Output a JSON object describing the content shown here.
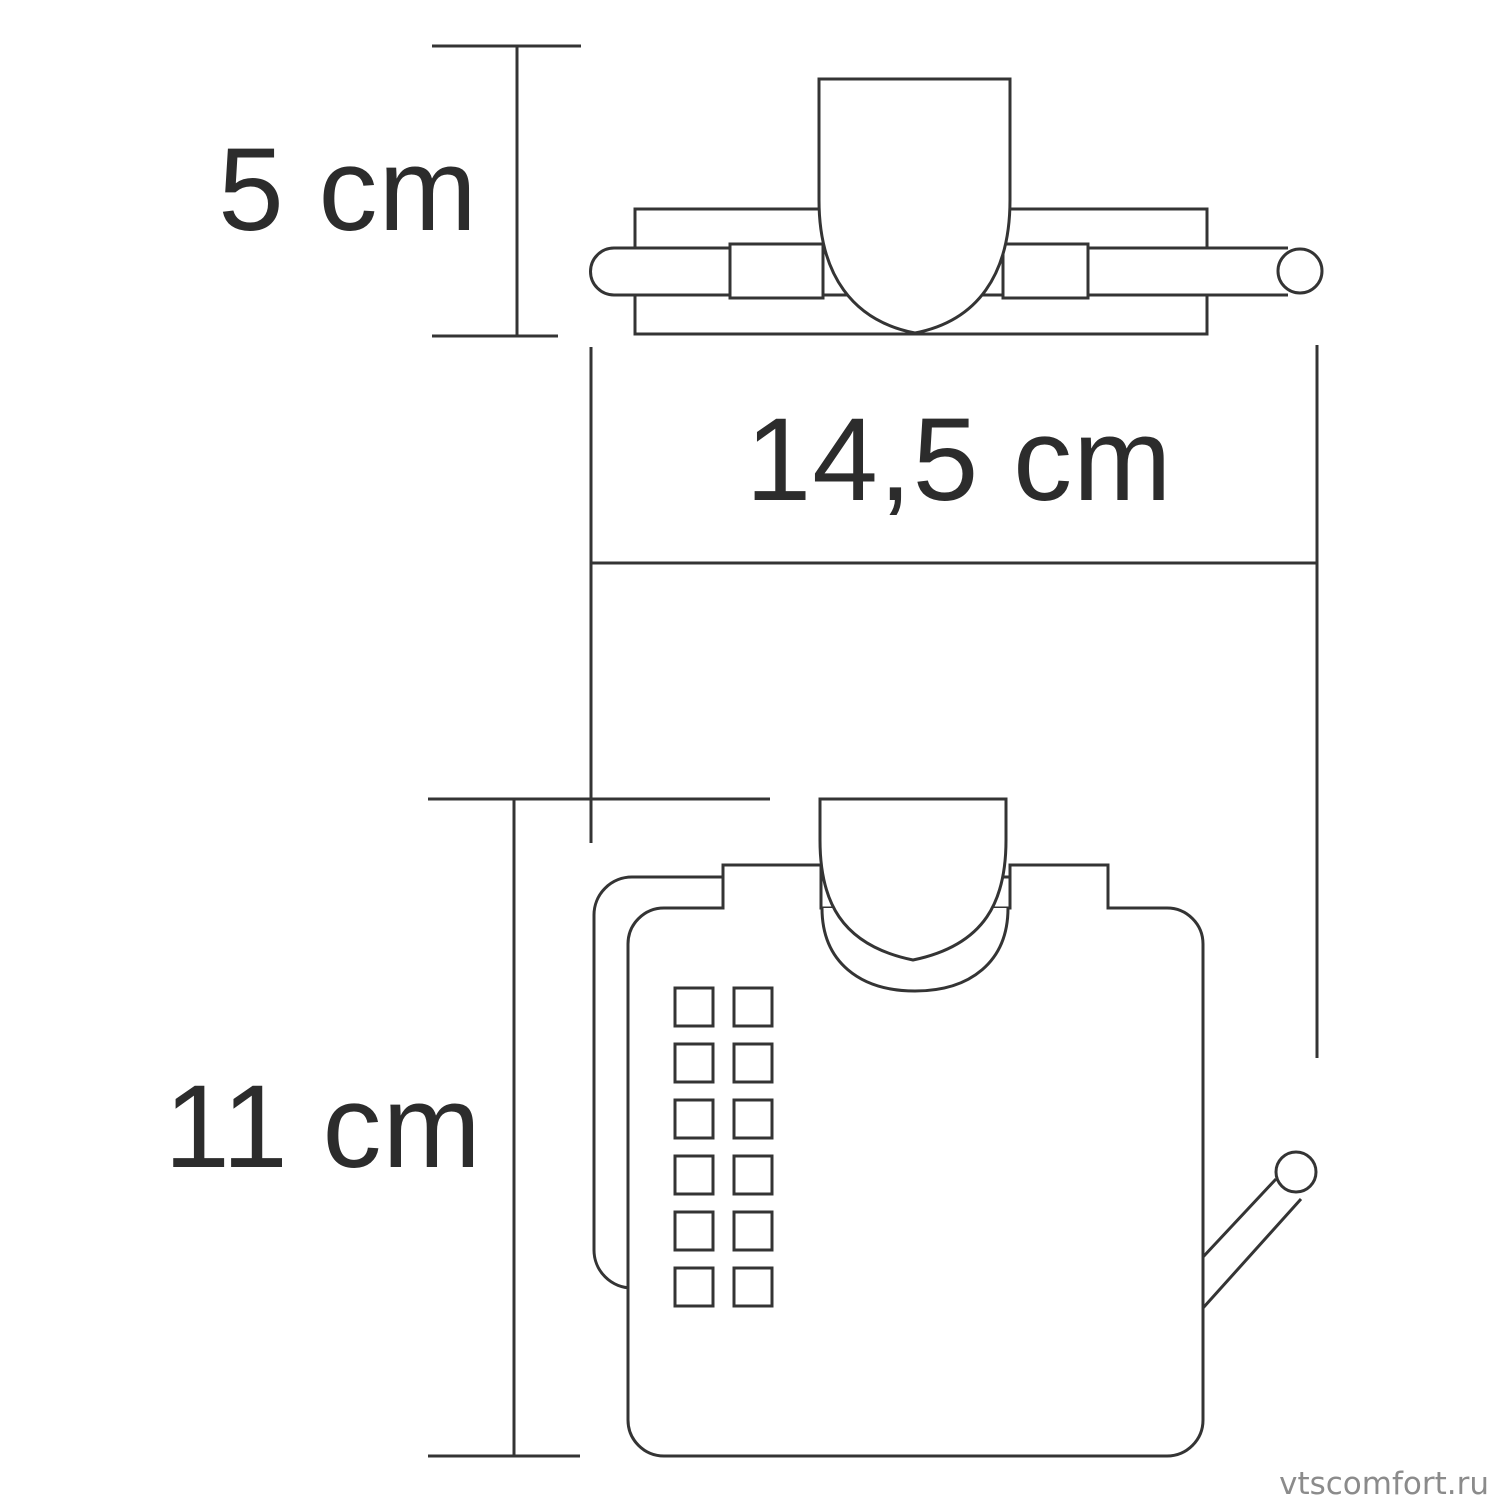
{
  "diagram": {
    "background": "#ffffff",
    "line_color": "#343434",
    "text_color": "#2c2c2c",
    "dimensions": [
      {
        "id": "depth",
        "label": "5 cm",
        "value_cm": 5
      },
      {
        "id": "width",
        "label": "14,5 cm",
        "value_cm": 14.5
      },
      {
        "id": "height",
        "label": "11 cm",
        "value_cm": 11
      }
    ],
    "watermark": {
      "text": "vtscomfort.ru",
      "color": "#8b8b8b"
    }
  }
}
